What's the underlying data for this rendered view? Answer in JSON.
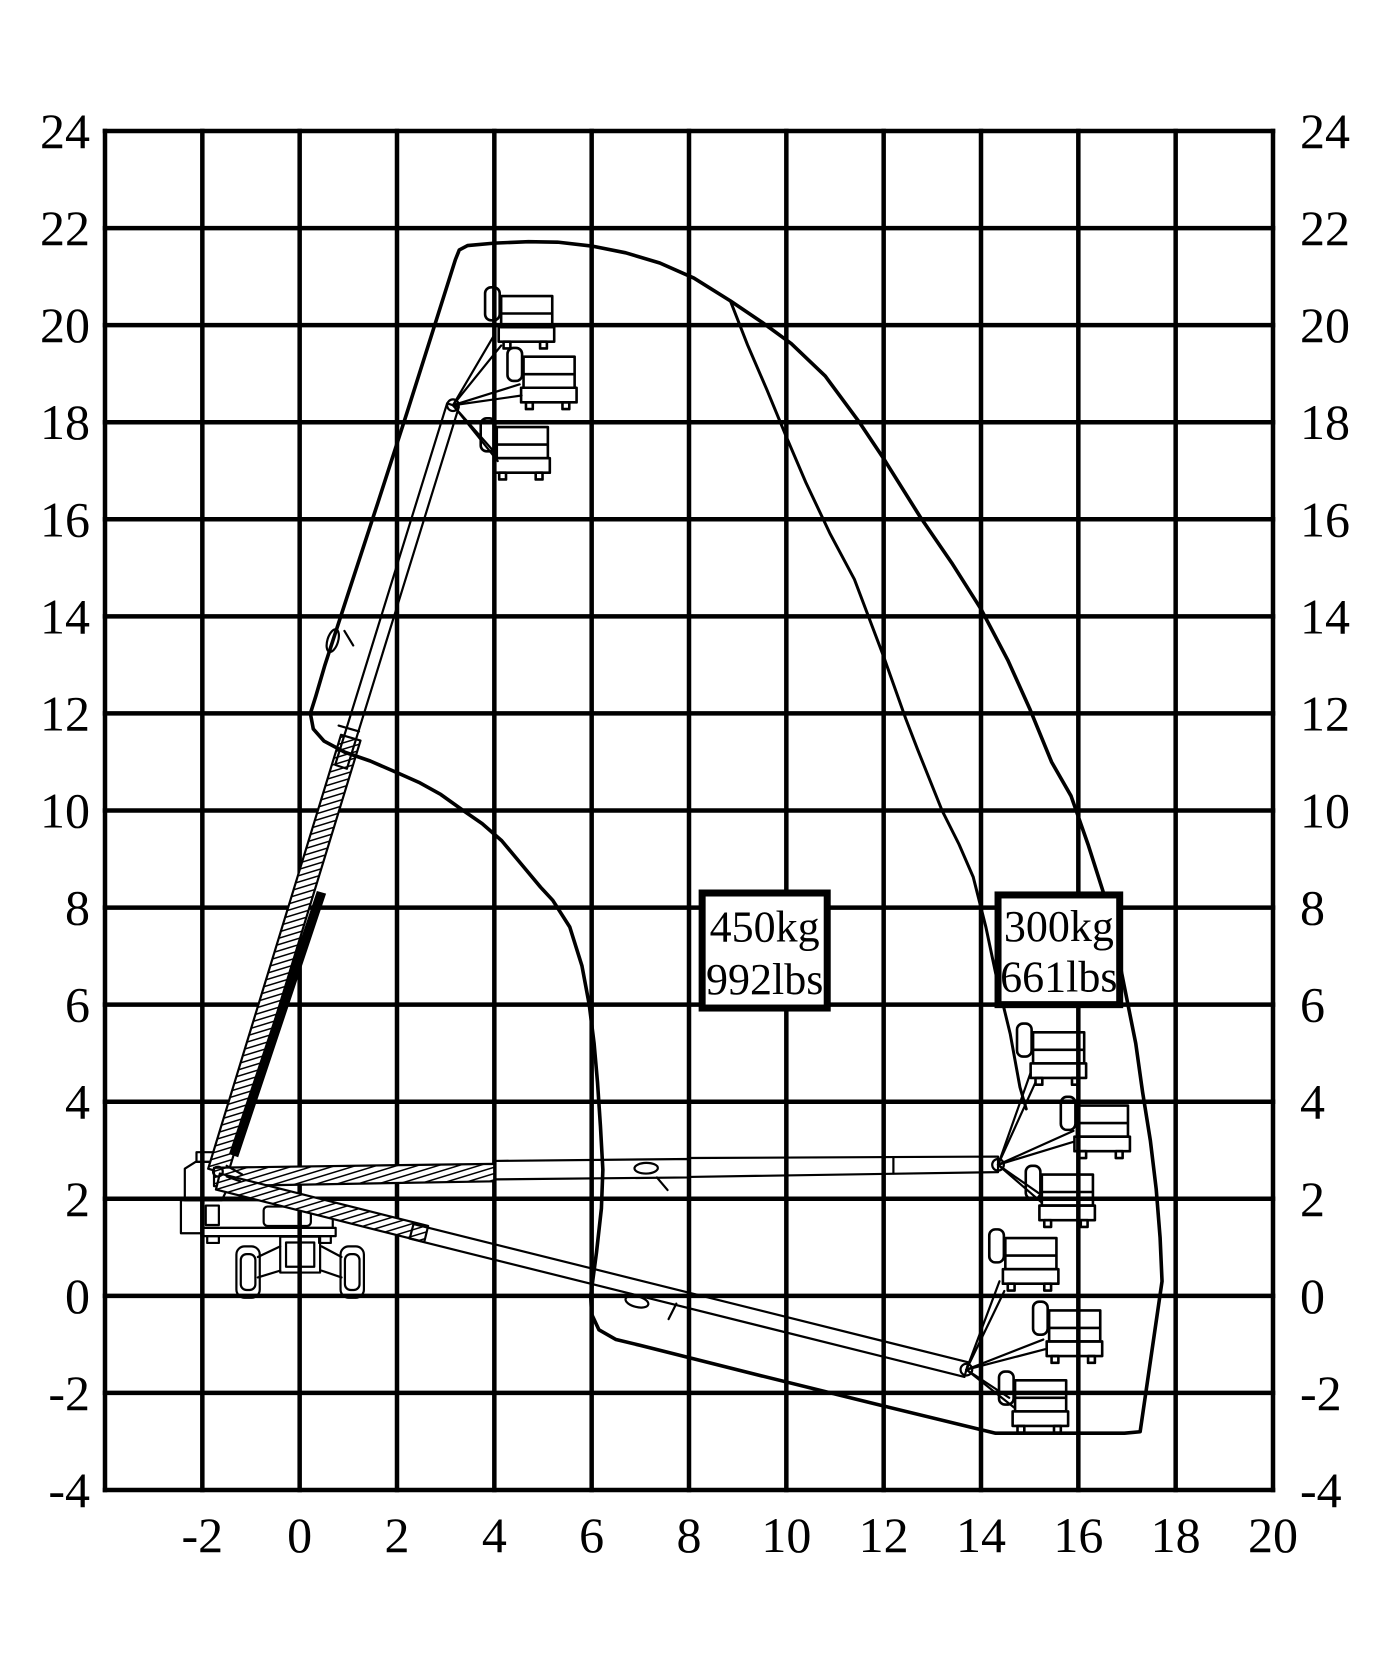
{
  "figure": {
    "width": 1400,
    "height": 1680,
    "background": "#ffffff",
    "ink": "#000000"
  },
  "chart_data": {
    "type": "area",
    "title": "",
    "xlabel": "",
    "ylabel": "",
    "axes": {
      "x": {
        "min": -4,
        "max": 20,
        "grid_step": 2,
        "ticks": [
          -2,
          0,
          2,
          4,
          6,
          8,
          10,
          12,
          14,
          16,
          18,
          20
        ]
      },
      "y": {
        "min": -4,
        "max": 24,
        "grid_step": 2,
        "ticks": [
          24,
          22,
          20,
          18,
          16,
          14,
          12,
          10,
          8,
          6,
          4,
          2,
          0,
          -2,
          -4
        ]
      },
      "grid": true,
      "y_labels_both_sides": true
    },
    "map_px": {
      "left": 105,
      "right": 1273,
      "top": 131,
      "bottom": 1490
    },
    "series": [
      {
        "name": "working-envelope-outline",
        "type": "outline",
        "closed": true,
        "points": [
          [
            3.2,
            21.35
          ],
          [
            3.28,
            21.55
          ],
          [
            3.45,
            21.64
          ],
          [
            4.0,
            21.69
          ],
          [
            4.7,
            21.72
          ],
          [
            5.3,
            21.71
          ],
          [
            6.0,
            21.63
          ],
          [
            6.7,
            21.49
          ],
          [
            7.4,
            21.28
          ],
          [
            8.1,
            20.97
          ],
          [
            8.85,
            20.5
          ],
          [
            9.5,
            20.06
          ],
          [
            10.1,
            19.62
          ],
          [
            10.8,
            18.95
          ],
          [
            11.5,
            18.0
          ],
          [
            12.0,
            17.25
          ],
          [
            12.75,
            16.05
          ],
          [
            13.4,
            15.1
          ],
          [
            14.0,
            14.15
          ],
          [
            14.55,
            13.1
          ],
          [
            15.0,
            12.1
          ],
          [
            15.45,
            11.0
          ],
          [
            15.85,
            10.3
          ],
          [
            16.2,
            9.3
          ],
          [
            16.55,
            8.2
          ],
          [
            16.8,
            7.1
          ],
          [
            17.0,
            6.1
          ],
          [
            17.18,
            5.2
          ],
          [
            17.32,
            4.2
          ],
          [
            17.48,
            3.2
          ],
          [
            17.6,
            2.2
          ],
          [
            17.68,
            1.2
          ],
          [
            17.72,
            0.3
          ],
          [
            17.27,
            -2.8
          ],
          [
            16.95,
            -2.83
          ],
          [
            14.3,
            -2.83
          ],
          [
            12.0,
            -2.27
          ],
          [
            9.5,
            -1.65
          ],
          [
            7.0,
            -1.02
          ],
          [
            6.5,
            -0.9
          ],
          [
            6.15,
            -0.7
          ],
          [
            6.0,
            -0.38
          ],
          [
            5.98,
            0.0
          ],
          [
            6.1,
            0.9
          ],
          [
            6.2,
            1.8
          ],
          [
            6.23,
            2.6
          ],
          [
            6.18,
            3.5
          ],
          [
            6.12,
            4.4
          ],
          [
            6.05,
            5.2
          ],
          [
            5.95,
            6.0
          ],
          [
            5.8,
            6.8
          ],
          [
            5.55,
            7.6
          ],
          [
            5.2,
            8.15
          ],
          [
            4.95,
            8.42
          ],
          [
            4.55,
            8.9
          ],
          [
            4.15,
            9.38
          ],
          [
            3.75,
            9.73
          ],
          [
            3.36,
            10.0
          ],
          [
            2.9,
            10.33
          ],
          [
            2.45,
            10.58
          ],
          [
            2.0,
            10.78
          ],
          [
            1.45,
            11.02
          ],
          [
            0.93,
            11.2
          ],
          [
            0.5,
            11.43
          ],
          [
            0.28,
            11.68
          ],
          [
            0.22,
            12.0
          ],
          [
            0.33,
            12.35
          ],
          [
            0.52,
            13.0
          ],
          [
            1.0,
            14.48
          ],
          [
            1.6,
            16.32
          ],
          [
            2.2,
            18.18
          ],
          [
            2.8,
            20.08
          ]
        ]
      },
      {
        "name": "capacity-zone-boundary",
        "type": "line",
        "closed": false,
        "points": [
          [
            8.85,
            20.5
          ],
          [
            9.2,
            19.6
          ],
          [
            9.6,
            18.67
          ],
          [
            10.0,
            17.7
          ],
          [
            10.4,
            16.76
          ],
          [
            10.9,
            15.7
          ],
          [
            11.4,
            14.76
          ],
          [
            12.0,
            13.17
          ],
          [
            12.45,
            11.9
          ],
          [
            12.7,
            11.25
          ],
          [
            13.2,
            10.0
          ],
          [
            13.55,
            9.3
          ],
          [
            13.84,
            8.63
          ],
          [
            14.1,
            7.6
          ],
          [
            14.33,
            6.51
          ],
          [
            14.6,
            5.4
          ],
          [
            14.8,
            4.3
          ],
          [
            14.93,
            3.85
          ]
        ]
      }
    ],
    "annotations": [
      {
        "name": "capacity-450kg",
        "lines": [
          "450kg",
          "992lbs"
        ],
        "box": {
          "x": 8.27,
          "y": 5.93,
          "w": 2.57,
          "h": 2.37
        }
      },
      {
        "name": "capacity-300kg",
        "lines": [
          "300kg",
          "661lbs"
        ],
        "box": {
          "x": 14.35,
          "y": 6.0,
          "w": 2.5,
          "h": 2.26
        }
      }
    ]
  },
  "machine_art": {
    "rects": [
      [
        -2.44,
        1.97,
        0.46,
        0.68,
        0
      ],
      [
        -1.93,
        1.86,
        0.27,
        0.4,
        0
      ],
      [
        -0.74,
        1.84,
        0.97,
        0.4,
        0.08
      ],
      [
        -2.02,
        1.4,
        2.76,
        0.17,
        0
      ],
      [
        -1.9,
        1.23,
        0.24,
        0.14,
        0
      ],
      [
        0.4,
        1.23,
        0.24,
        0.14,
        0
      ],
      [
        -0.4,
        1.22,
        0.82,
        0.74,
        0
      ],
      [
        -0.28,
        1.1,
        0.58,
        0.5,
        0
      ],
      [
        -1.3,
        1.02,
        0.48,
        1.06,
        0.17
      ],
      [
        -1.21,
        0.86,
        0.3,
        0.74,
        0.12
      ],
      [
        0.84,
        1.02,
        0.48,
        1.06,
        0.17
      ],
      [
        0.93,
        0.86,
        0.3,
        0.74,
        0.12
      ],
      [
        -2.12,
        2.96,
        0.34,
        0.2,
        0
      ]
    ],
    "polys": [
      {
        "pts": [
          [
            -2.02,
            1.97
          ],
          [
            0.38,
            1.97
          ],
          [
            0.62,
            1.86
          ],
          [
            0.68,
            1.7
          ],
          [
            0.68,
            1.4
          ],
          [
            -2.02,
            1.4
          ]
        ],
        "fill": "none"
      },
      {
        "pts": [
          [
            -2.36,
            1.97
          ],
          [
            -2.36,
            2.62
          ],
          [
            -2.14,
            2.76
          ],
          [
            -1.7,
            2.76
          ],
          [
            -1.52,
            2.6
          ],
          [
            -1.48,
            2.22
          ],
          [
            -1.6,
            1.97
          ]
        ],
        "fill": "none"
      },
      {
        "pts": [
          [
            -1.88,
            2.62
          ],
          [
            -1.48,
            2.5
          ],
          [
            1.25,
            11.44
          ],
          [
            0.85,
            11.56
          ]
        ],
        "fill": "hatch"
      },
      {
        "pts": [
          [
            0.73,
            10.94
          ],
          [
            0.97,
            10.86
          ],
          [
            3.27,
            18.31
          ],
          [
            3.03,
            18.39
          ]
        ],
        "fill": "none"
      },
      {
        "pts": [
          [
            -1.44,
            2.93
          ],
          [
            -1.27,
            2.87
          ],
          [
            0.53,
            8.28
          ],
          [
            0.36,
            8.33
          ]
        ],
        "fill": "ink"
      },
      {
        "pts": [
          [
            -1.76,
            2.64
          ],
          [
            4.0,
            2.72
          ],
          [
            4.0,
            2.36
          ],
          [
            -1.76,
            2.26
          ]
        ],
        "fill": "hatch"
      },
      {
        "pts": [
          [
            4.0,
            2.78
          ],
          [
            8.0,
            2.82
          ],
          [
            8.0,
            2.44
          ],
          [
            4.0,
            2.4
          ]
        ],
        "fill": "none"
      },
      {
        "pts": [
          [
            8.0,
            2.84
          ],
          [
            14.35,
            2.87
          ],
          [
            14.35,
            2.55
          ],
          [
            8.0,
            2.45
          ]
        ],
        "fill": "none"
      },
      {
        "pts": [
          [
            -1.64,
            2.52
          ],
          [
            2.64,
            1.44
          ],
          [
            2.56,
            1.11
          ],
          [
            -1.72,
            2.19
          ]
        ],
        "fill": "hatch"
      },
      {
        "pts": [
          [
            2.34,
            1.48
          ],
          [
            13.74,
            -1.37
          ],
          [
            13.66,
            -1.67
          ],
          [
            2.26,
            1.18
          ]
        ],
        "fill": "none"
      }
    ],
    "lines": [
      [
        -0.4,
        1.02,
        -0.86,
        0.8
      ],
      [
        -0.4,
        0.52,
        -0.86,
        0.38
      ],
      [
        0.45,
        1.02,
        0.86,
        0.8
      ],
      [
        0.45,
        0.52,
        0.86,
        0.38
      ],
      [
        -1.5,
        2.68,
        -1.18,
        2.5
      ],
      [
        -1.5,
        2.46,
        -1.22,
        2.36
      ],
      [
        0.8,
        11.75,
        1.22,
        11.63
      ],
      [
        0.92,
        13.7,
        1.1,
        13.4
      ],
      [
        3.15,
        18.35,
        4.0,
        19.8
      ],
      [
        3.15,
        18.35,
        4.14,
        19.58
      ],
      [
        3.15,
        18.35,
        4.52,
        18.78
      ],
      [
        3.15,
        18.35,
        4.56,
        18.55
      ],
      [
        3.15,
        18.35,
        3.97,
        17.42
      ],
      [
        3.15,
        18.35,
        4.07,
        17.2
      ],
      [
        7.34,
        2.44,
        7.56,
        2.18
      ],
      [
        12.2,
        2.86,
        12.2,
        2.52
      ],
      [
        14.35,
        2.7,
        15.02,
        4.6
      ],
      [
        14.35,
        2.7,
        15.12,
        4.4
      ],
      [
        14.35,
        2.7,
        15.9,
        3.4
      ],
      [
        14.35,
        2.7,
        15.92,
        3.18
      ],
      [
        14.35,
        2.7,
        15.18,
        2.12
      ],
      [
        14.35,
        2.7,
        15.25,
        1.92
      ],
      [
        7.74,
        -0.16,
        7.58,
        -0.48
      ],
      [
        13.7,
        -1.52,
        14.38,
        0.3
      ],
      [
        13.7,
        -1.52,
        14.48,
        0.1
      ],
      [
        13.7,
        -1.52,
        15.28,
        -0.9
      ],
      [
        13.7,
        -1.52,
        15.32,
        -1.1
      ],
      [
        13.7,
        -1.52,
        14.58,
        -2.1
      ],
      [
        13.7,
        -1.52,
        14.68,
        -2.3
      ]
    ],
    "circles": [
      [
        -1.68,
        2.56,
        0.1
      ],
      [
        3.15,
        18.35,
        0.12
      ],
      [
        14.35,
        2.7,
        0.12
      ],
      [
        13.7,
        -1.52,
        0.12
      ]
    ],
    "ellipses": [
      [
        0.68,
        13.5,
        0.24,
        0.11,
        -73
      ],
      [
        7.12,
        2.63,
        0.24,
        0.11,
        -1
      ],
      [
        6.93,
        -0.12,
        0.24,
        0.11,
        14
      ]
    ],
    "baskets": [
      [
        4.14,
        20.6
      ],
      [
        4.6,
        19.35
      ],
      [
        4.05,
        17.9
      ],
      [
        15.07,
        5.43
      ],
      [
        15.97,
        3.92
      ],
      [
        15.25,
        2.5
      ],
      [
        14.5,
        1.19
      ],
      [
        15.4,
        -0.3
      ],
      [
        14.7,
        -1.74
      ]
    ],
    "basket_geom": {
      "rail_w": 1.05,
      "rail_h": 0.64,
      "floor_w": 1.14,
      "floor_h": 0.3,
      "back_w": 0.3,
      "back_h": 0.68
    }
  }
}
